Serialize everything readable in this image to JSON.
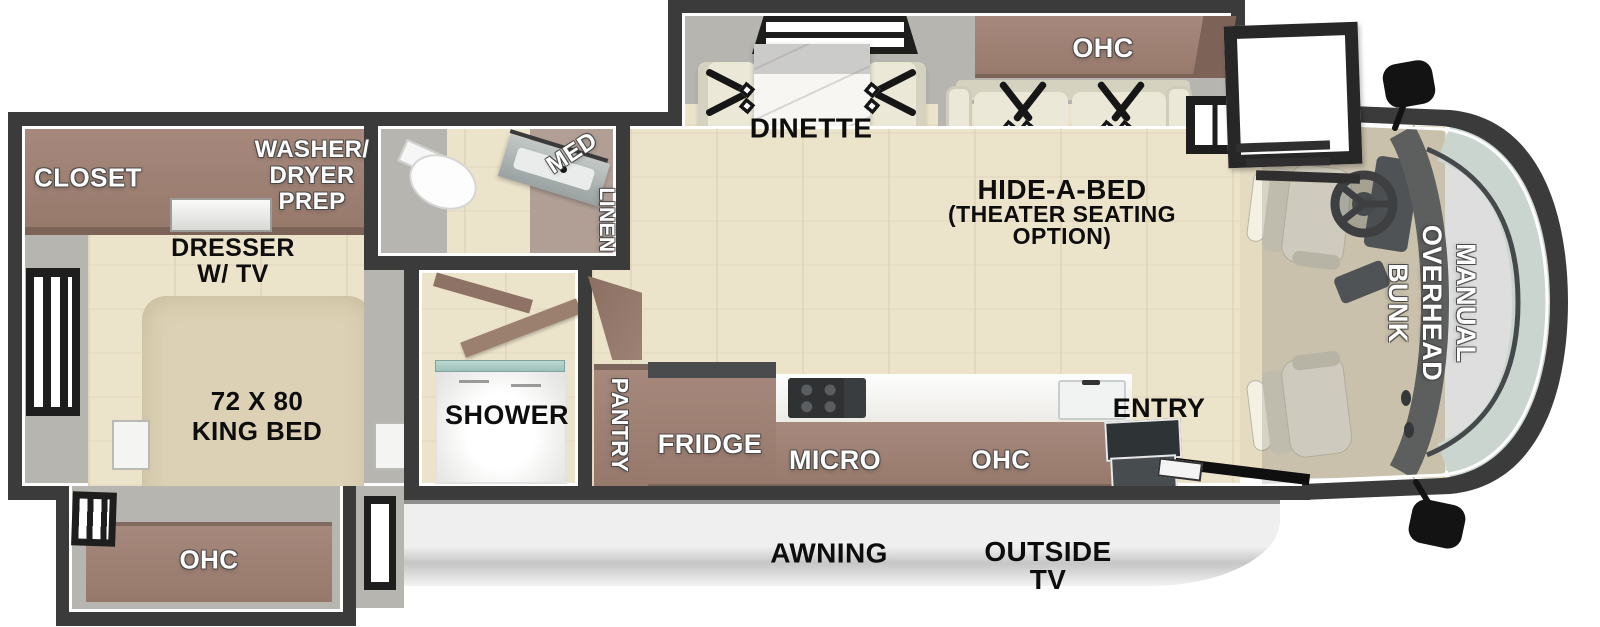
{
  "colors": {
    "wall": "#3b3b3b",
    "wall_inner": "#ffffff",
    "gray_band": "#b6b5af",
    "gray_dark": "#a3a29c",
    "floor": "#ece3cb",
    "cabinet": "#97796c",
    "cabinet_dark": "#7c6257",
    "cabinet_light": "#a6897c",
    "cream": "#ece8d7",
    "cream_dark": "#d6d2c0",
    "bed": "#dcd1b4",
    "marble": "#f7f6f3",
    "mauve": "#b19f96",
    "belt": "#161616",
    "glass": "#cbd5cf",
    "console": "#5d615e",
    "awning_hi": "#efefef",
    "awning_lo": "#c6c6c6",
    "step_dark": "#2e3336",
    "step_mid": "#474c4f",
    "shower_glass": "#9fc0ba",
    "window_frame": "#1e1e1e",
    "label_dark": "#0d0d0d",
    "label_light": "#ffffff"
  },
  "rooms": {
    "closet": "CLOSET",
    "washer_dryer_prep": [
      "WASHER/",
      "DRYER",
      "PREP"
    ],
    "dresser": [
      "DRESSER",
      "W/ TV"
    ],
    "king_bed": [
      "72 X 80",
      "KING BED"
    ],
    "bedroom_ohc": "OHC",
    "med": "MED",
    "linen": "LINEN",
    "shower": "SHOWER",
    "pantry": "PANTRY",
    "fridge": "FRIDGE",
    "micro": "MICRO",
    "kitchen_ohc": "OHC",
    "entry": "ENTRY",
    "dinette": "DINETTE",
    "living_ohc": "OHC",
    "hide_a_bed": [
      "HIDE-A-BED",
      "(THEATER SEATING",
      "OPTION)"
    ],
    "overhead_bunk": [
      "MANUAL",
      "OVERHEAD",
      "BUNK"
    ],
    "awning": "AWNING",
    "outside_tv": [
      "OUTSIDE",
      "TV"
    ]
  }
}
